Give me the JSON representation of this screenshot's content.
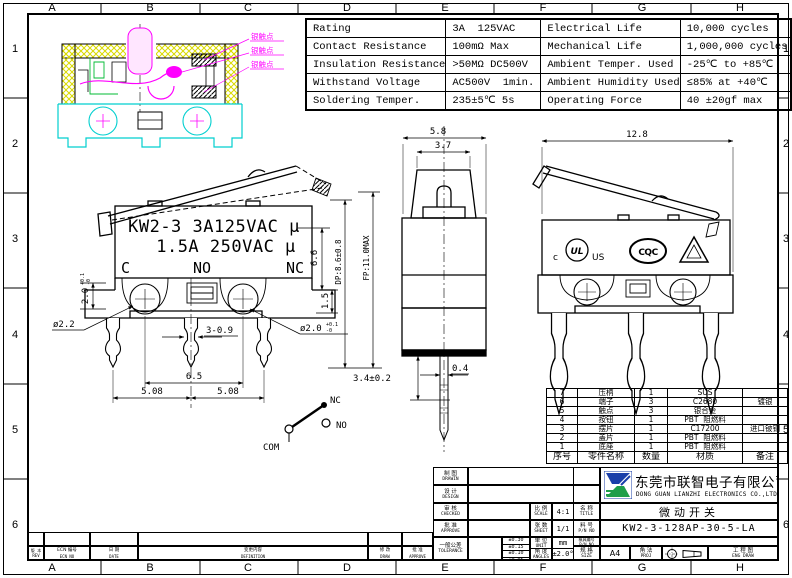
{
  "frame": {
    "letters": [
      "A",
      "B",
      "C",
      "D",
      "E",
      "F",
      "G",
      "H"
    ],
    "numbers": [
      "1",
      "2",
      "3",
      "4",
      "5",
      "6"
    ]
  },
  "spec_table": {
    "rows": [
      [
        "Rating",
        "3A  125VAC",
        "Electrical Life",
        "10,000 cycles"
      ],
      [
        "Contact Resistance",
        "100mΩ Max",
        "Mechanical Life",
        "1,000,000 cycles"
      ],
      [
        "Insulation Resistance",
        ">50MΩ DC500V",
        "Ambient Temper. Used",
        "-25℃ to +85℃"
      ],
      [
        "Withstand Voltage",
        "AC500V  1min.",
        "Ambient Humidity Used",
        "≤85% at +40℃"
      ],
      [
        "Soldering Temper.",
        "235±5℃ 5s",
        "Operating Force",
        "40 ±20gf max"
      ]
    ]
  },
  "section_view": {
    "labels": [
      "银触点",
      "银触点",
      "银触点"
    ]
  },
  "side_view": {
    "marking1": "KW2-3 3A125VAC μ",
    "marking2": "1.5A 250VAC μ",
    "term_c": "C",
    "term_no": "NO",
    "term_nc": "NC",
    "dim_slot": "2.0",
    "dim_slot_tol_up": "+0.1",
    "dim_slot_tol_dn": "-0",
    "dim_hole_left": "ø2.2",
    "dim_pins": "3-0.9",
    "dim_hole_right": "ø2.0",
    "dim_hole_right_tol_up": "+0.1",
    "dim_hole_right_tol_dn": "-0",
    "dim_15": "1.5",
    "dim_66": "6.6",
    "dim_dp": "DP:8.6±0.8",
    "dim_fp": "FP:11.0MAX",
    "dim_65": "6.5",
    "dim_508a": "5.08",
    "dim_508b": "5.08"
  },
  "front_view": {
    "dim_58": "5.8",
    "dim_37": "3.7",
    "dim_34": "3.4±0.2",
    "dim_04": "0.4"
  },
  "rear_view": {
    "dim_128": "12.8",
    "ul_c": "c",
    "ul": "UL",
    "ul_us": "US",
    "cqc": "CQC"
  },
  "schematic": {
    "nc": "NC",
    "no": "NO",
    "com": "COM"
  },
  "parts_table": {
    "headers": [
      "序号",
      "零件名称",
      "数量",
      "材质",
      "备注"
    ],
    "rows": [
      [
        "7",
        "压柄",
        "1",
        "SUS",
        ""
      ],
      [
        "6",
        "端子",
        "3",
        "C2680",
        "镀银"
      ],
      [
        "5",
        "触点",
        "3",
        "银合金",
        ""
      ],
      [
        "4",
        "按钮",
        "1",
        "PBT  阻燃料",
        ""
      ],
      [
        "3",
        "摆片",
        "1",
        "C17200",
        "进口铍铜"
      ],
      [
        "2",
        "盖片",
        "1",
        "PBT  阻燃料",
        ""
      ],
      [
        "1",
        "底座",
        "1",
        "PBT  阻燃料",
        ""
      ]
    ]
  },
  "title_block": {
    "drawn_cn": "制 图",
    "drawn_en": "DRAWIN",
    "design_cn": "设 计",
    "design_en": "DESIGN",
    "checked_cn": "审 核",
    "checked_en": "CHECKED",
    "approve_cn": "批 准",
    "approve_en": "APPROVE",
    "tol_cn": "一般公差",
    "tol_en": "TOLERANCE",
    "tols": [
      "±0.30",
      "±0.15",
      "±0.10",
      "±0.05"
    ],
    "scale_cn": "比 例",
    "scale_en": "SCALE",
    "scale_val": "4:1",
    "sheet_cn": "张 数",
    "sheet_en": "SHEET",
    "sheet_val": "1/1",
    "unit_cn": "单 位",
    "unit_en": "UNIT",
    "unit_val": "mm",
    "angles_cn": "角 度",
    "angles_en": "ANGLES",
    "angles_val": "±2.0°",
    "title_cn": "名 称",
    "title_en": "TITLE",
    "title_val": "微动开关",
    "pn_cn": "料 号",
    "pn_en": "P/N NO",
    "pn_val": "KW2-3-128AP-30-5-LA",
    "mold_cn": "模具编号",
    "mold_en": "P/N NO",
    "mold_val": "",
    "size_cn": "规 格",
    "size_en": "SIZE",
    "size_val": "A4",
    "proj_cn": "角 法",
    "proj_en": "PROJ",
    "eng_cn": "工 程 图",
    "eng_en": "ENG DRAW"
  },
  "company": {
    "cn": "东莞市联智电子有限公司",
    "en": "DONG GUAN LIANZHI ELECTRONICS CO.,LTD."
  },
  "rev_table": {
    "rev_cn": "版 本",
    "rev_en": "REV",
    "ecn_cn": "ECN 编号",
    "ecn_en": "ECN NO",
    "date_cn": "日 期",
    "date_en": "DATE",
    "def_cn": "变更内容",
    "def_en": "DEFINITION",
    "draw_cn": "修 改",
    "draw_en": "DRAW",
    "appr_cn": "批 准",
    "appr_en": "APPROVE"
  }
}
